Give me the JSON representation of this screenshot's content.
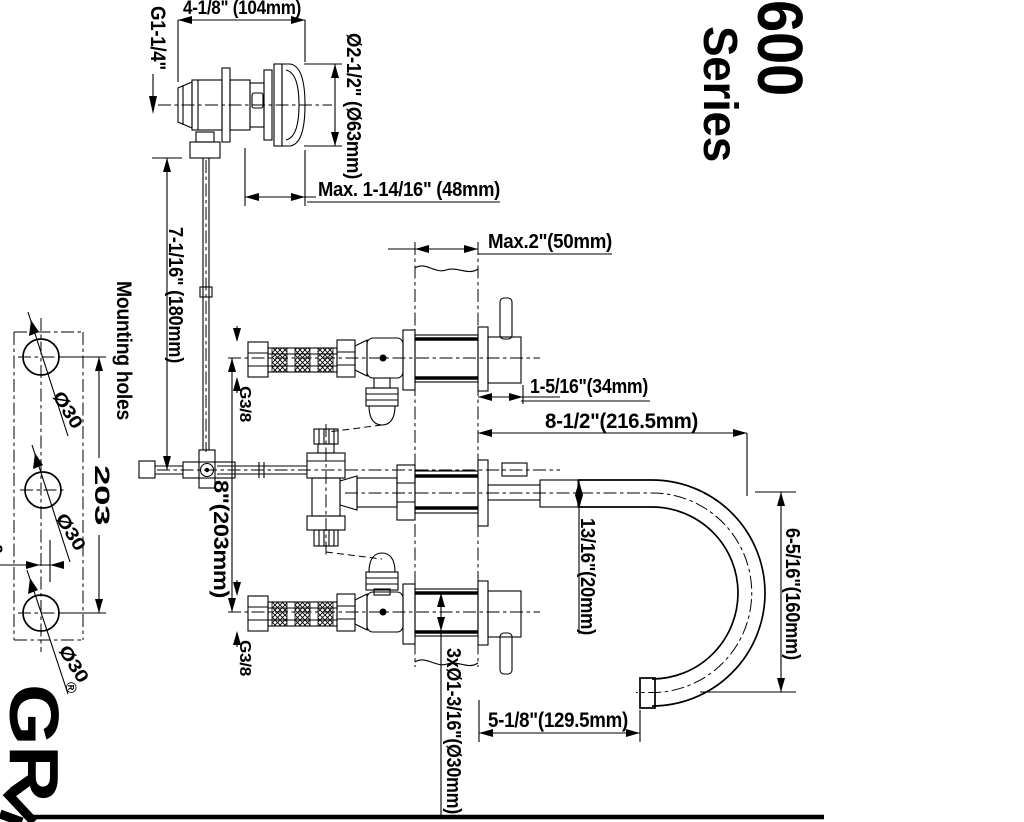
{
  "series": {
    "number": "600",
    "word": "Series"
  },
  "brand": {
    "letters": "GR",
    "registered": "®"
  },
  "labels": {
    "inlet_thread": "G1-1/4\"",
    "valve_length": "4-1/8\" (104mm)",
    "valve_diameter": "Ø2-1/2\" (Ø63mm)",
    "max_mount_top": "Max. 1-14/16\" (48mm)",
    "max_wall": "Max.2\"(50mm)",
    "riser_height": "7-1/16\" (180mm)",
    "mounting_holes": "Mounting holes",
    "hole_dia_top": "Ø30",
    "hole_dia_middle": "Ø30",
    "hole_dia_bottom": "Ø30",
    "hole_spacing": "203",
    "hole_offset_partial": "6",
    "supply_thread_top": "G3/8",
    "supply_thread_bottom": "G3/8",
    "valve_centers": "8\"(203mm)",
    "handle_projection": "1-5/16\"(34mm)",
    "spout_reach": "8-1/2\"(216.5mm)",
    "tube_diameter": "13/16\"(20mm)",
    "spout_height": "6-5/16\"(160mm)",
    "mounting_hole_spec": "3xØ1-3/16\"(Ø30mm)",
    "outlet_distance": "5-1/8\"(129.5mm)"
  }
}
